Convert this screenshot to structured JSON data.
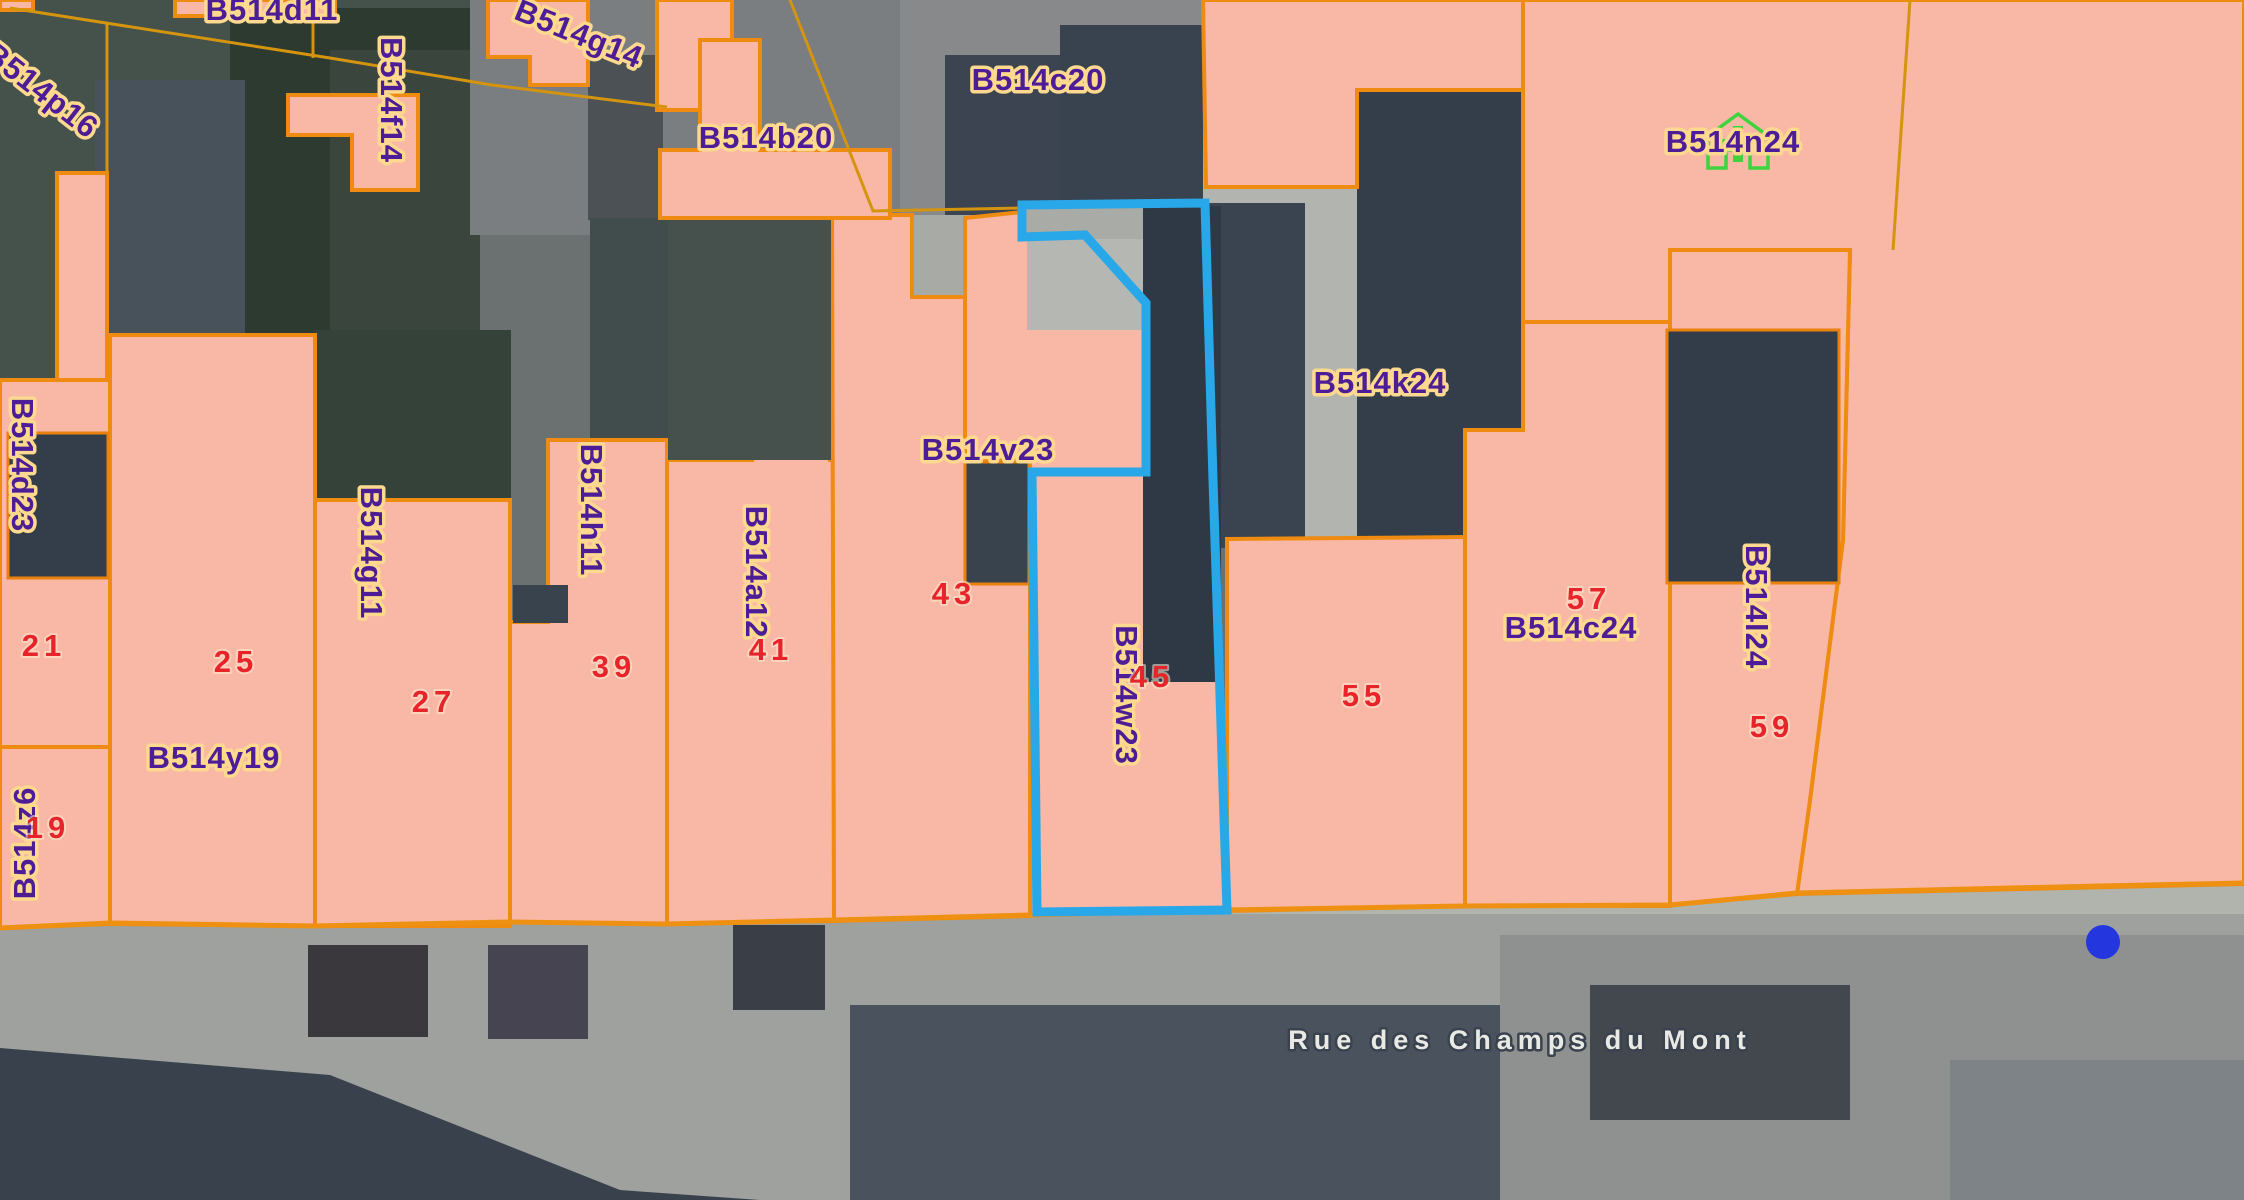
{
  "map": {
    "title": "Cadastral parcel map",
    "street_label": "Rue des Champs du Mont",
    "selected_parcel": "B514w23",
    "colors": {
      "parcel_fill": "#f9b7a5",
      "parcel_border": "#ee8b10",
      "highlight_stroke": "#29a8e9",
      "parcel_label_fill": "#4c1d96",
      "parcel_label_halo": "#fcd98e",
      "house_number_fill": "#e6242a",
      "street_label_fill": "#e9eae4",
      "marker_fill": "#2437de",
      "house_icon_green": "#3ed43e"
    },
    "parcel_labels": [
      {
        "text": "B514d11",
        "x": 272,
        "y": 12,
        "rot": 0
      },
      {
        "text": "B514g14",
        "x": 578,
        "y": 36,
        "rot": 22
      },
      {
        "text": "B514p16",
        "x": 40,
        "y": 92,
        "rot": 38
      },
      {
        "text": "B514f14",
        "x": 389,
        "y": 100,
        "rot": 90
      },
      {
        "text": "B514b20",
        "x": 766,
        "y": 140,
        "rot": 0
      },
      {
        "text": "B514c20",
        "x": 1038,
        "y": 82,
        "rot": 0
      },
      {
        "text": "B514n24",
        "x": 1733,
        "y": 144,
        "rot": 0
      },
      {
        "text": "B514k24",
        "x": 1380,
        "y": 385,
        "rot": 0
      },
      {
        "text": "B514v23",
        "x": 988,
        "y": 452,
        "rot": 0
      },
      {
        "text": "B514d23",
        "x": 20,
        "y": 465,
        "rot": 90
      },
      {
        "text": "B514g11",
        "x": 369,
        "y": 553,
        "rot": 90
      },
      {
        "text": "B514h11",
        "x": 589,
        "y": 510,
        "rot": 90
      },
      {
        "text": "B514a12",
        "x": 754,
        "y": 572,
        "rot": 90
      },
      {
        "text": "B514w23",
        "x": 1124,
        "y": 695,
        "rot": 90
      },
      {
        "text": "B514y19",
        "x": 214,
        "y": 760,
        "rot": 0
      },
      {
        "text": "B514c24",
        "x": 1571,
        "y": 630,
        "rot": 0
      },
      {
        "text": "B514l24",
        "x": 1754,
        "y": 607,
        "rot": 90
      },
      {
        "text": "B514z6",
        "x": 27,
        "y": 843,
        "rot": -90
      }
    ],
    "house_numbers": [
      {
        "text": "19",
        "x": 48,
        "y": 830
      },
      {
        "text": "21",
        "x": 44,
        "y": 648
      },
      {
        "text": "25",
        "x": 236,
        "y": 664
      },
      {
        "text": "27",
        "x": 434,
        "y": 704
      },
      {
        "text": "39",
        "x": 614,
        "y": 669
      },
      {
        "text": "41",
        "x": 771,
        "y": 652
      },
      {
        "text": "43",
        "x": 954,
        "y": 596
      },
      {
        "text": "45",
        "x": 1152,
        "y": 679
      },
      {
        "text": "55",
        "x": 1364,
        "y": 698
      },
      {
        "text": "57",
        "x": 1589,
        "y": 601
      },
      {
        "text": "59",
        "x": 1772,
        "y": 729
      }
    ],
    "street_label_pos": {
      "x": 1520,
      "y": 1042
    },
    "marker": {
      "x": 2103,
      "y": 942,
      "r": 17
    },
    "house_icon": {
      "x": 1738,
      "y": 140
    }
  }
}
